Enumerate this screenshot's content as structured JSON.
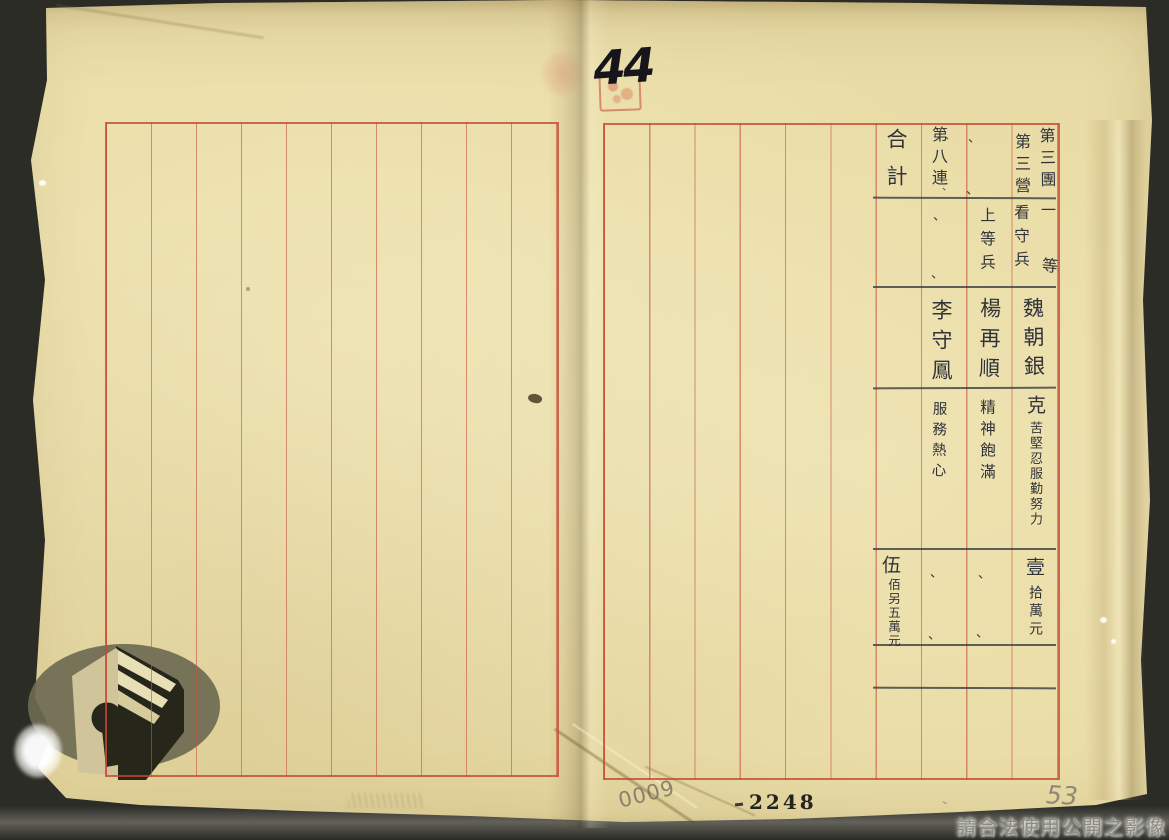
{
  "document": {
    "handwritten_sheet_number": "44",
    "printed_page_number": "2248",
    "pencil_number_left": "0009",
    "pencil_number_right": "53",
    "pencil_tick": "、",
    "watermark_text": "請合法使用公開之影像"
  },
  "table": {
    "col1": {
      "unit_right": "第三團",
      "unit_left": "第三營",
      "rank_top": "一",
      "rank_bottom": "等",
      "rank_left": "看守兵",
      "name": "魏朝銀",
      "citation_first": "克",
      "citation_rest": "苦堅忍服勤努力",
      "amount_first": "壹",
      "amount_rest": "拾萬元"
    },
    "col2": {
      "unit_ditto_top": "、",
      "unit_ditto_bottom": "、",
      "rank": "上等兵",
      "name": "楊再順",
      "citation": "精神飽滿",
      "amount_ditto_top": "、",
      "amount_ditto_bottom": "、"
    },
    "col3": {
      "unit": "第八連",
      "unit_ditto_top": "、",
      "unit_ditto_bottom": "、",
      "rank_ditto_top": "、",
      "rank_ditto_bottom": "、",
      "name": "李守鳳",
      "citation": "服務熱心",
      "amount_ditto_top": "、",
      "amount_ditto_bottom": "、"
    },
    "col4": {
      "header": "合計",
      "amount_first": "伍",
      "amount_rest": "佰另五萬元"
    }
  },
  "icons": {
    "red_seal": "red-square-seal-stamp",
    "logo": "archives-open-book-keyhole-logo"
  },
  "colors": {
    "paper": "#e9dca6",
    "rule_red": "#c3462f",
    "ink": "#31333b",
    "watermark_gray": "#8d8b7d"
  }
}
